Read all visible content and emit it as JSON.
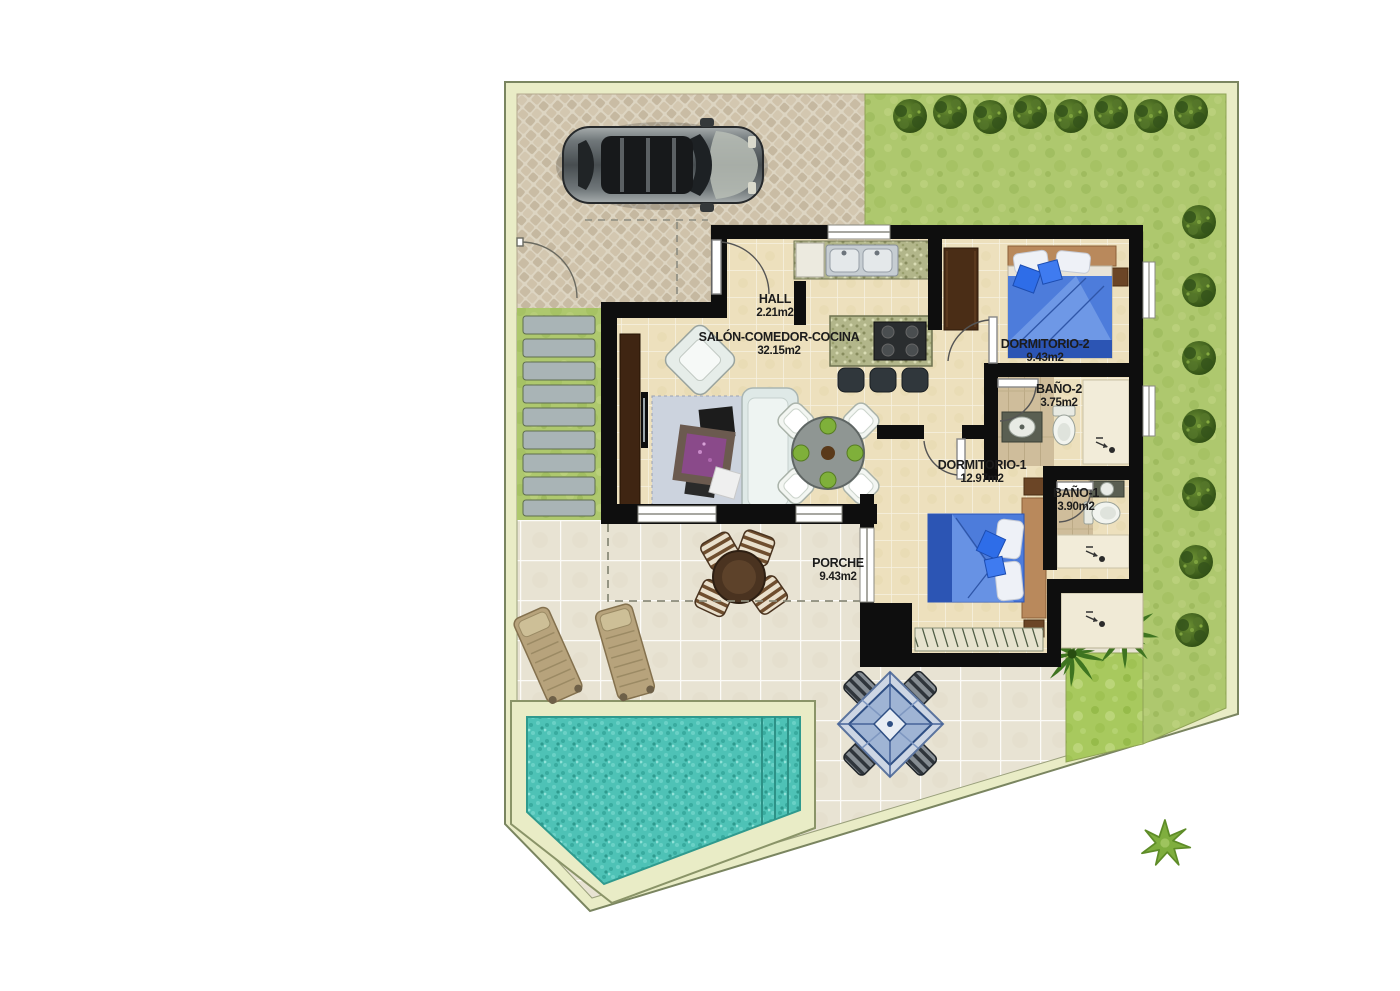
{
  "plan": {
    "type": "villa-floor-plan",
    "rooms": [
      {
        "id": "hall",
        "name": "HALL",
        "area": "2.21m2"
      },
      {
        "id": "salon",
        "name": "SALÓN-COMEDOR-COCINA",
        "area": "32.15m2"
      },
      {
        "id": "dormitorio2",
        "name": "DORMITORIO-2",
        "area": "9.43m2"
      },
      {
        "id": "bano2",
        "name": "BAÑO-2",
        "area": "3.75m2"
      },
      {
        "id": "dormitorio1",
        "name": "DORMITORIO-1",
        "area": "12.97m2"
      },
      {
        "id": "bano1",
        "name": "BAÑO-1",
        "area": "3.90m2"
      },
      {
        "id": "porche",
        "name": "PORCHE",
        "area": "9.43m2"
      }
    ],
    "site_features": [
      "driveway",
      "parked-car",
      "lawn-garden",
      "hedge-bushes",
      "stepping-stones",
      "terrace",
      "swimming-pool",
      "sun-loungers",
      "porch-table",
      "gazebo",
      "palm-trees"
    ],
    "palette": {
      "plot_border": "#e9ecc6",
      "grass": "#aec86e",
      "grass_bright": "#a8c95e",
      "driveway": "#cdc0a8",
      "terrace_tile": "#e8e3d3",
      "house_floor": "#ede0bd",
      "wall": "#0e0e0e",
      "pool_water": "#4ec2b6",
      "bed_blue": "#4d7cdb",
      "label_text": "#1c1c1c"
    }
  }
}
